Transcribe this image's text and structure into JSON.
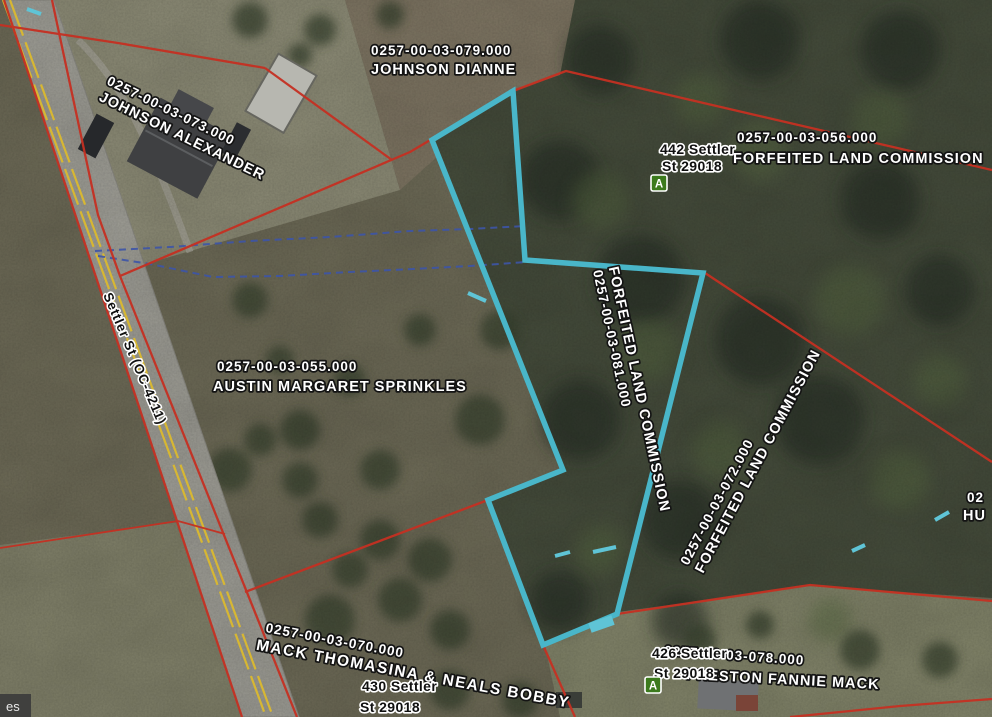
{
  "map": {
    "road_label": "Settler St (OC-4211)",
    "attribution": "es",
    "parcels": {
      "p079": {
        "id": "0257-00-03-079.000",
        "owner": "JOHNSON DIANNE"
      },
      "p073": {
        "id": "0257-00-03-073.000",
        "owner": "JOHNSON ALEXANDER"
      },
      "p056": {
        "id": "0257-00-03-056.000",
        "owner": "FORFEITED LAND COMMISSION"
      },
      "p081": {
        "id": "0257-00-03-081.000",
        "owner": "FORFEITED LAND COMMISSION"
      },
      "p055": {
        "id": "0257-00-03-055.000",
        "owner": "AUSTIN MARGARET SPRINKLES"
      },
      "p072": {
        "id": "0257-00-03-072.000",
        "owner": "FORFEITED LAND COMMISSION"
      },
      "p070": {
        "id": "0257-00-03-070.000",
        "owner": "MACK THOMASINA & NEALS BOBBY"
      },
      "p078": {
        "id": "0257-00-03-078.000",
        "owner": "PRESTON FANNIE MACK"
      },
      "edge_partial": {
        "id": "02",
        "owner": "HU"
      }
    },
    "addresses": {
      "a442": {
        "line1": "442 Settler",
        "line2": "St 29018",
        "marker": "A"
      },
      "a430": {
        "line1": "430 Settler",
        "line2": "St 29018"
      },
      "a426": {
        "line1": "426 Settler",
        "line2": "St 29018",
        "marker": "A"
      }
    },
    "colors": {
      "selected_parcel": "#49b6c9",
      "parcel_boundary": "#c53022",
      "hydro_line": "#3d55a8",
      "road_centerline": "#d7b733",
      "address_marker": "#3c7a1d"
    }
  }
}
